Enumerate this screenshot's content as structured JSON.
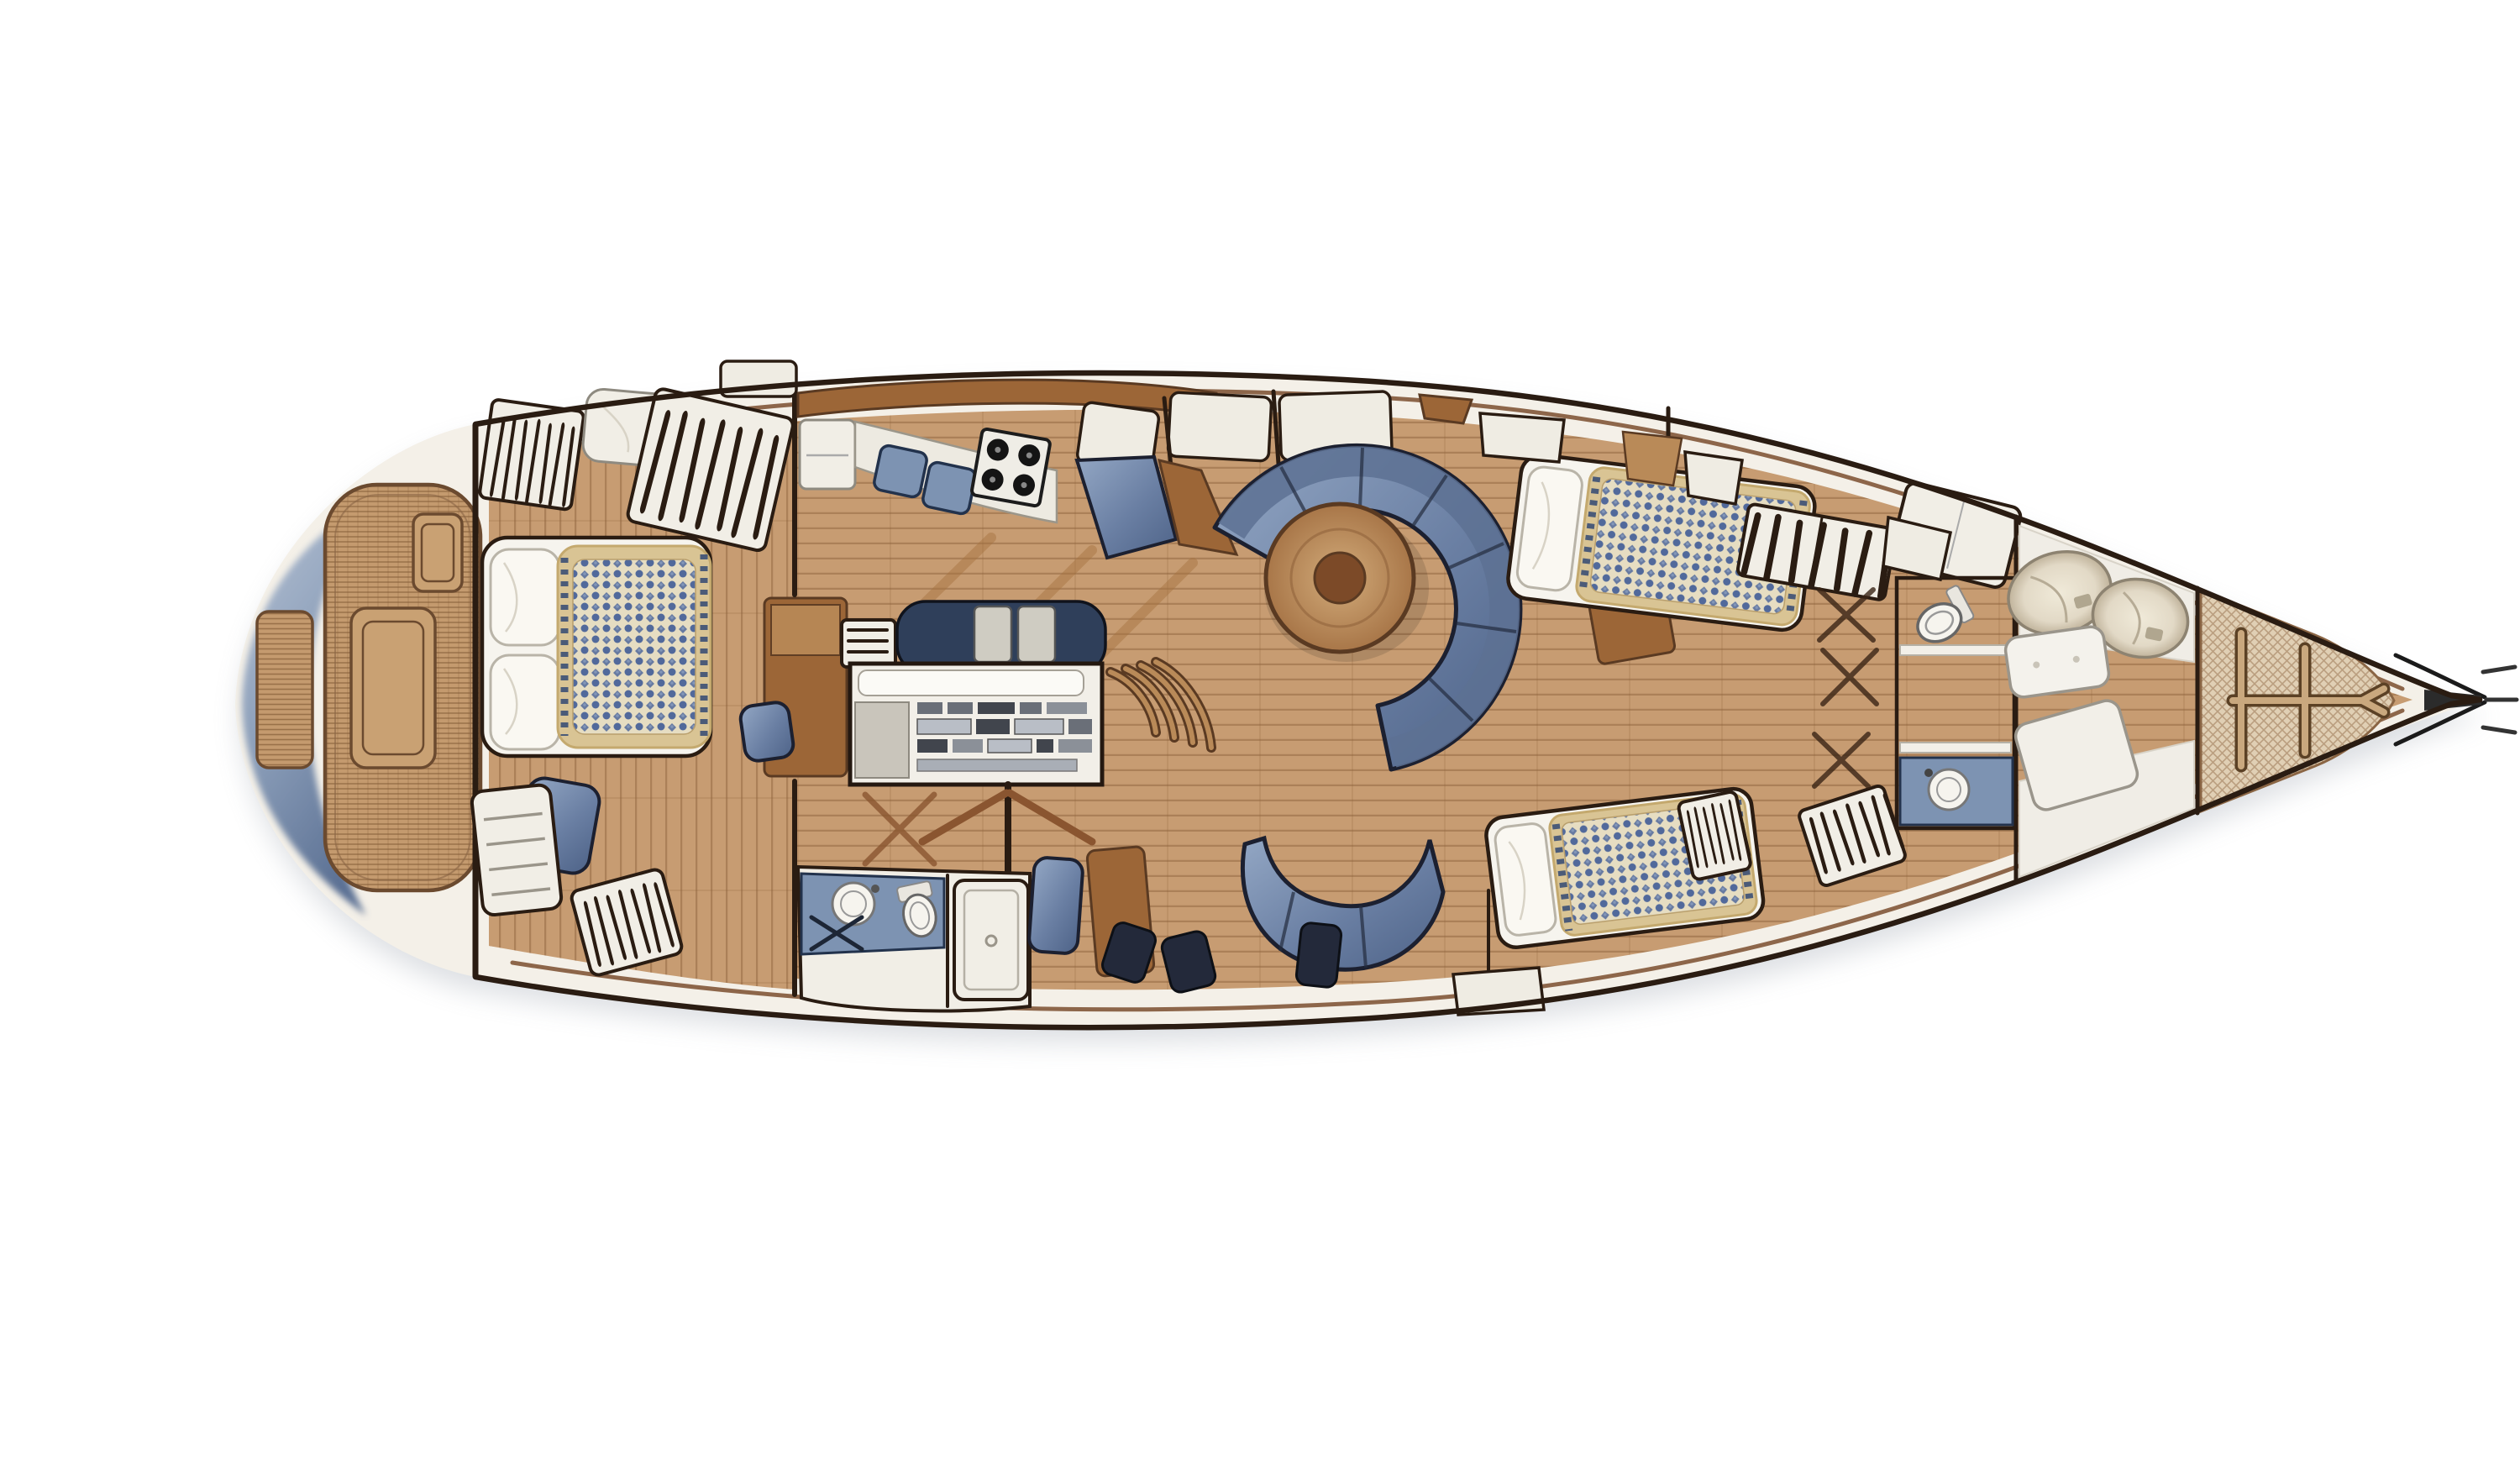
{
  "illustration": {
    "subject": "sailing-yacht-interior-floor-plan",
    "view": "overhead-plan",
    "bow_direction": "right",
    "stern_direction": "left",
    "alt": "Top-down interior layout plan of a sailing yacht with aft swim platform, woven teak aft deck, aft owner cabin, galley, navigation station, circular salon settee with round table, two heads, two guest cabins, sail locker and bow trampoline"
  },
  "colors": {
    "background": "#ffffff",
    "hull_outline": "#2a1c12",
    "deck": "#f4f0e8",
    "wood": "#c79c72",
    "wood_line": "#8a5c36",
    "wood_dark": "#b98a58",
    "furniture": "#9c6637",
    "furniture_dark": "#5a3a22",
    "trim": "#7a4e2e",
    "weave_base": "#c49a6e",
    "weave_line": "#7c5430",
    "transom_light": "#b2bfd2",
    "transom_mid": "#8a9db8",
    "transom_dark": "#5c7194",
    "upholstery_light": "#93a7c4",
    "upholstery_mid": "#6a7fa3",
    "upholstery_dark": "#4e6388",
    "upholstery_back": "#5d7193",
    "upholstery_seam": "#232c3f",
    "cushion_navy": "#23293a",
    "pillow": "#f6f4ee",
    "fixture": "#f1eee6",
    "fixture_line": "#8e8a80",
    "counter_blue": "#7d93b2",
    "counter_blue_line": "#22324c",
    "spread_border": "#d9c494",
    "spread_field": "#e6ddc2",
    "spread_motif": "#51699b",
    "fringe_navy": "#3c5076",
    "stove_panel": "#efede6",
    "stove_burner": "#141414",
    "table_light": "#d2ab7a",
    "table_dark": "#a87648",
    "table_hub": "#7c4a28",
    "mesh_base": "#e0cfb4",
    "mesh_line": "#936e49",
    "frame_tan": "#c9a87e",
    "frame_shadow": "#5b4125",
    "bag_beige": "#e2d9c6",
    "bag_line": "#8d8371",
    "rail_black": "#1b1b1b",
    "shadow": "#8d95a2"
  },
  "areas": [
    {
      "id": "swim-platform",
      "label": "Stern swim platform with teak step"
    },
    {
      "id": "aft-deck",
      "label": "Woven teak aft deck with two hatches"
    },
    {
      "id": "aft-cabin",
      "label": "Aft owner's cabin with centerline double berth"
    },
    {
      "id": "galley",
      "label": "Galley with stove, sink lids and bench"
    },
    {
      "id": "nav-station",
      "label": "Navigation station with instrument panel"
    },
    {
      "id": "aft-head",
      "label": "Aft head with basin, toilet and shower stall"
    },
    {
      "id": "salon",
      "label": "Salon with circular settee and round table"
    },
    {
      "id": "lower-settee",
      "label": "Lower salon settee and ottomans"
    },
    {
      "id": "starboard-guest-cabin",
      "label": "Guest cabin with double berth and hanging locker"
    },
    {
      "id": "port-guest-cabin",
      "label": "Guest cabin with berth and hanging lockers"
    },
    {
      "id": "forward-head",
      "label": "Forward head with toilet and basin"
    },
    {
      "id": "sail-locker",
      "label": "Forepeak sail locker with sail bags"
    },
    {
      "id": "bow-net",
      "label": "Bow trampoline net with tan frame"
    },
    {
      "id": "bowsprit",
      "label": "Bow tip with anchor roller and stays"
    }
  ]
}
